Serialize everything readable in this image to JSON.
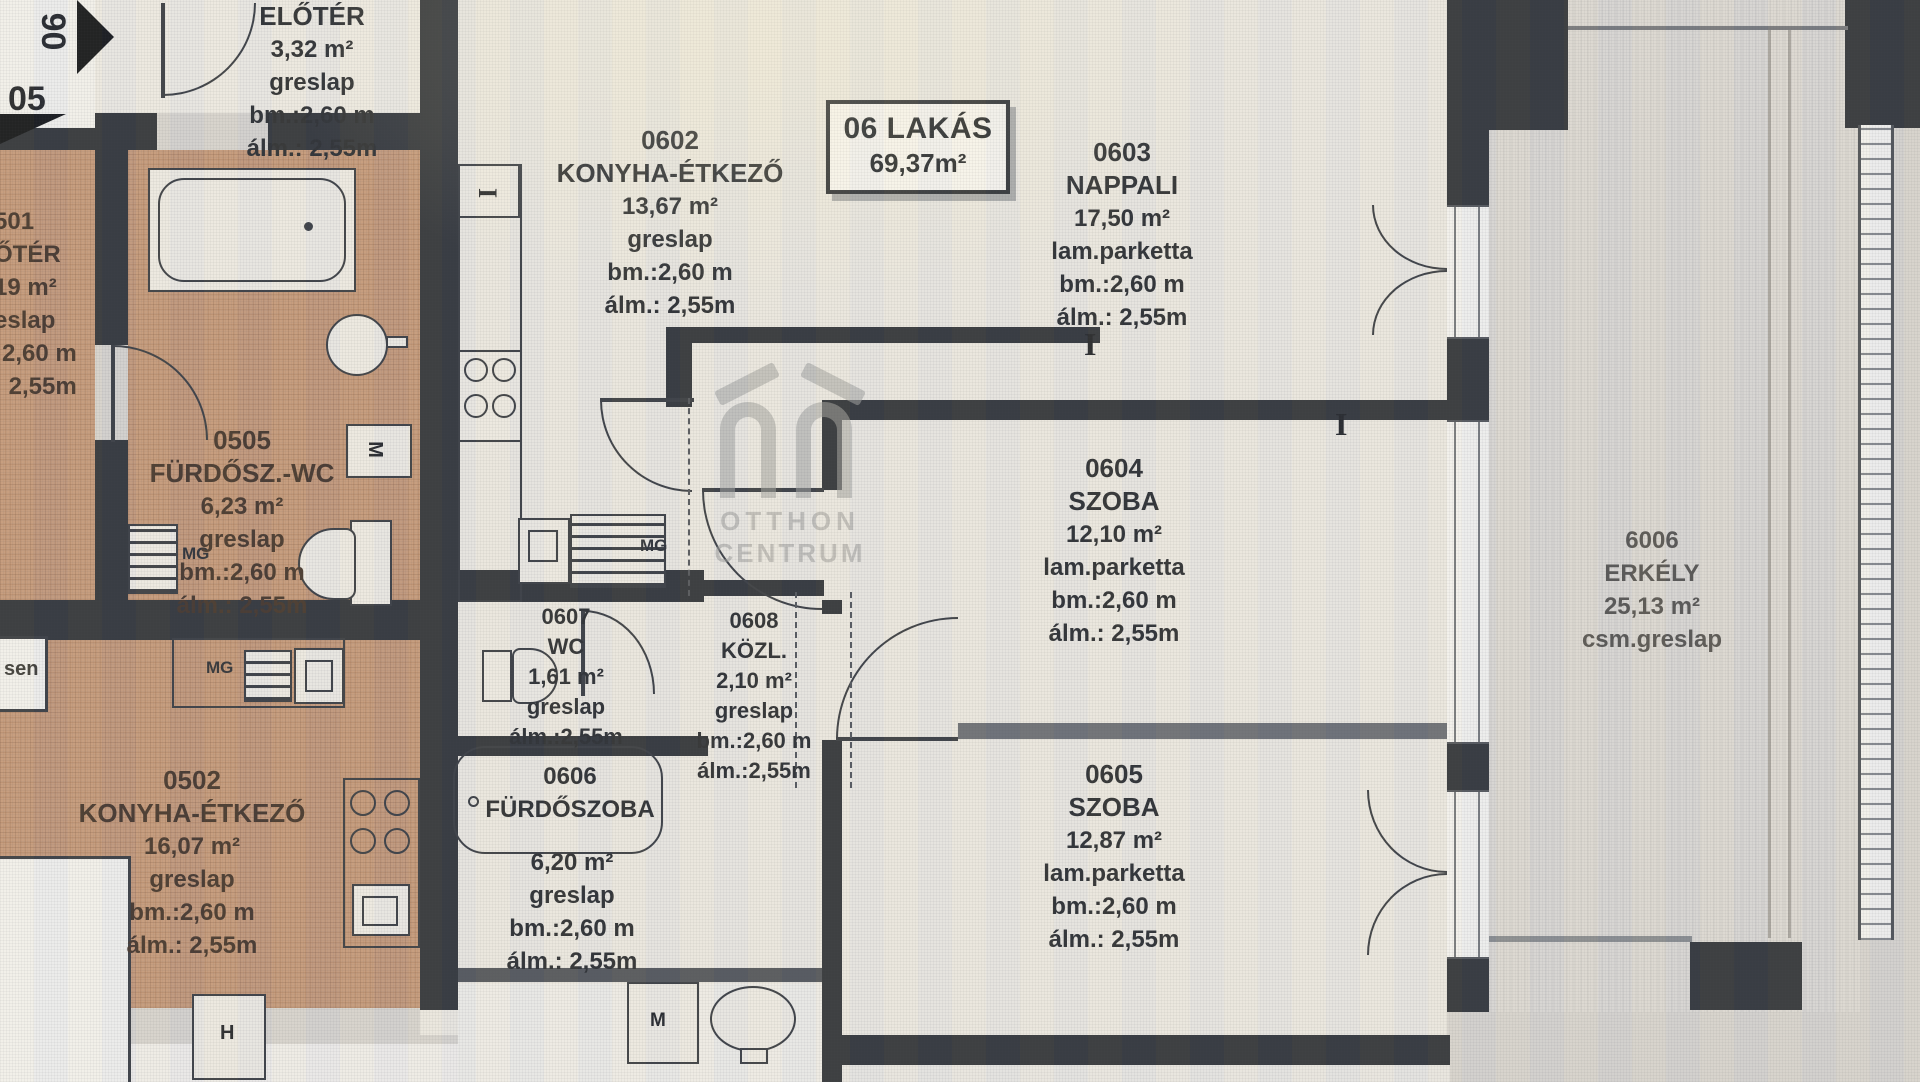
{
  "unit_box": {
    "title": "06 LAKÁS",
    "area": "69,37m²"
  },
  "watermark": {
    "line1": "OTTHON",
    "line2": "CENTRUM"
  },
  "markers": {
    "unit06": "06",
    "unit05": "05"
  },
  "rooms": {
    "eloter06": {
      "name": "ELŐTÉR",
      "area": "3,32 m²",
      "floor": "greslap",
      "bm": "bm.:2,60 m",
      "alm": "álm.: 2,55m"
    },
    "r0602": {
      "code": "0602",
      "name": "KONYHA-ÉTKEZŐ",
      "area": "13,67 m²",
      "floor": "greslap",
      "bm": "bm.:2,60 m",
      "alm": "álm.: 2,55m"
    },
    "r0603": {
      "code": "0603",
      "name": "NAPPALI",
      "area": "17,50 m²",
      "floor": "lam.parketta",
      "bm": "bm.:2,60 m",
      "alm": "álm.: 2,55m"
    },
    "r0604": {
      "code": "0604",
      "name": "SZOBA",
      "area": "12,10 m²",
      "floor": "lam.parketta",
      "bm": "bm.:2,60 m",
      "alm": "álm.: 2,55m"
    },
    "r0605": {
      "code": "0605",
      "name": "SZOBA",
      "area": "12,87 m²",
      "floor": "lam.parketta",
      "bm": "bm.:2,60 m",
      "alm": "álm.: 2,55m"
    },
    "r0606": {
      "code": "0606",
      "name": "FÜRDŐSZOBA",
      "area": "6,20 m²",
      "floor": "greslap",
      "bm": "bm.:2,60 m",
      "alm": "álm.: 2,55m"
    },
    "r0607": {
      "code": "0607",
      "name": "WC",
      "area": "1,61 m²",
      "floor": "greslap",
      "alm": "álm.:2,55m"
    },
    "r0608": {
      "code": "0608",
      "name": "KÖZL.",
      "area": "2,10 m²",
      "floor": "greslap",
      "bm": "bm.:2,60 m",
      "alm": "álm.:2,55m"
    },
    "erkely": {
      "code": "6006",
      "name": "ERKÉLY",
      "area": "25,13 m²",
      "floor": "csm.greslap"
    },
    "r0505": {
      "code": "0505",
      "name": "FÜRDŐSZ.-WC",
      "area": "6,23 m²",
      "floor": "greslap",
      "bm": "bm.:2,60 m",
      "alm": "álm.: 2,55m"
    },
    "r0502": {
      "code": "0502",
      "name": "KONYHA-ÉTKEZŐ",
      "area": "16,07 m²",
      "floor": "greslap",
      "bm": "bm.:2,60 m",
      "alm": "álm.: 2,55m"
    },
    "r0501": {
      "lines": [
        "501",
        "ŐTÉR",
        "19 m²",
        "eslap",
        ":2,60 m",
        ": 2,55m"
      ]
    }
  },
  "labels": {
    "mg": "MG",
    "m": "M",
    "h": "H",
    "i": "I",
    "sen": "sen"
  }
}
